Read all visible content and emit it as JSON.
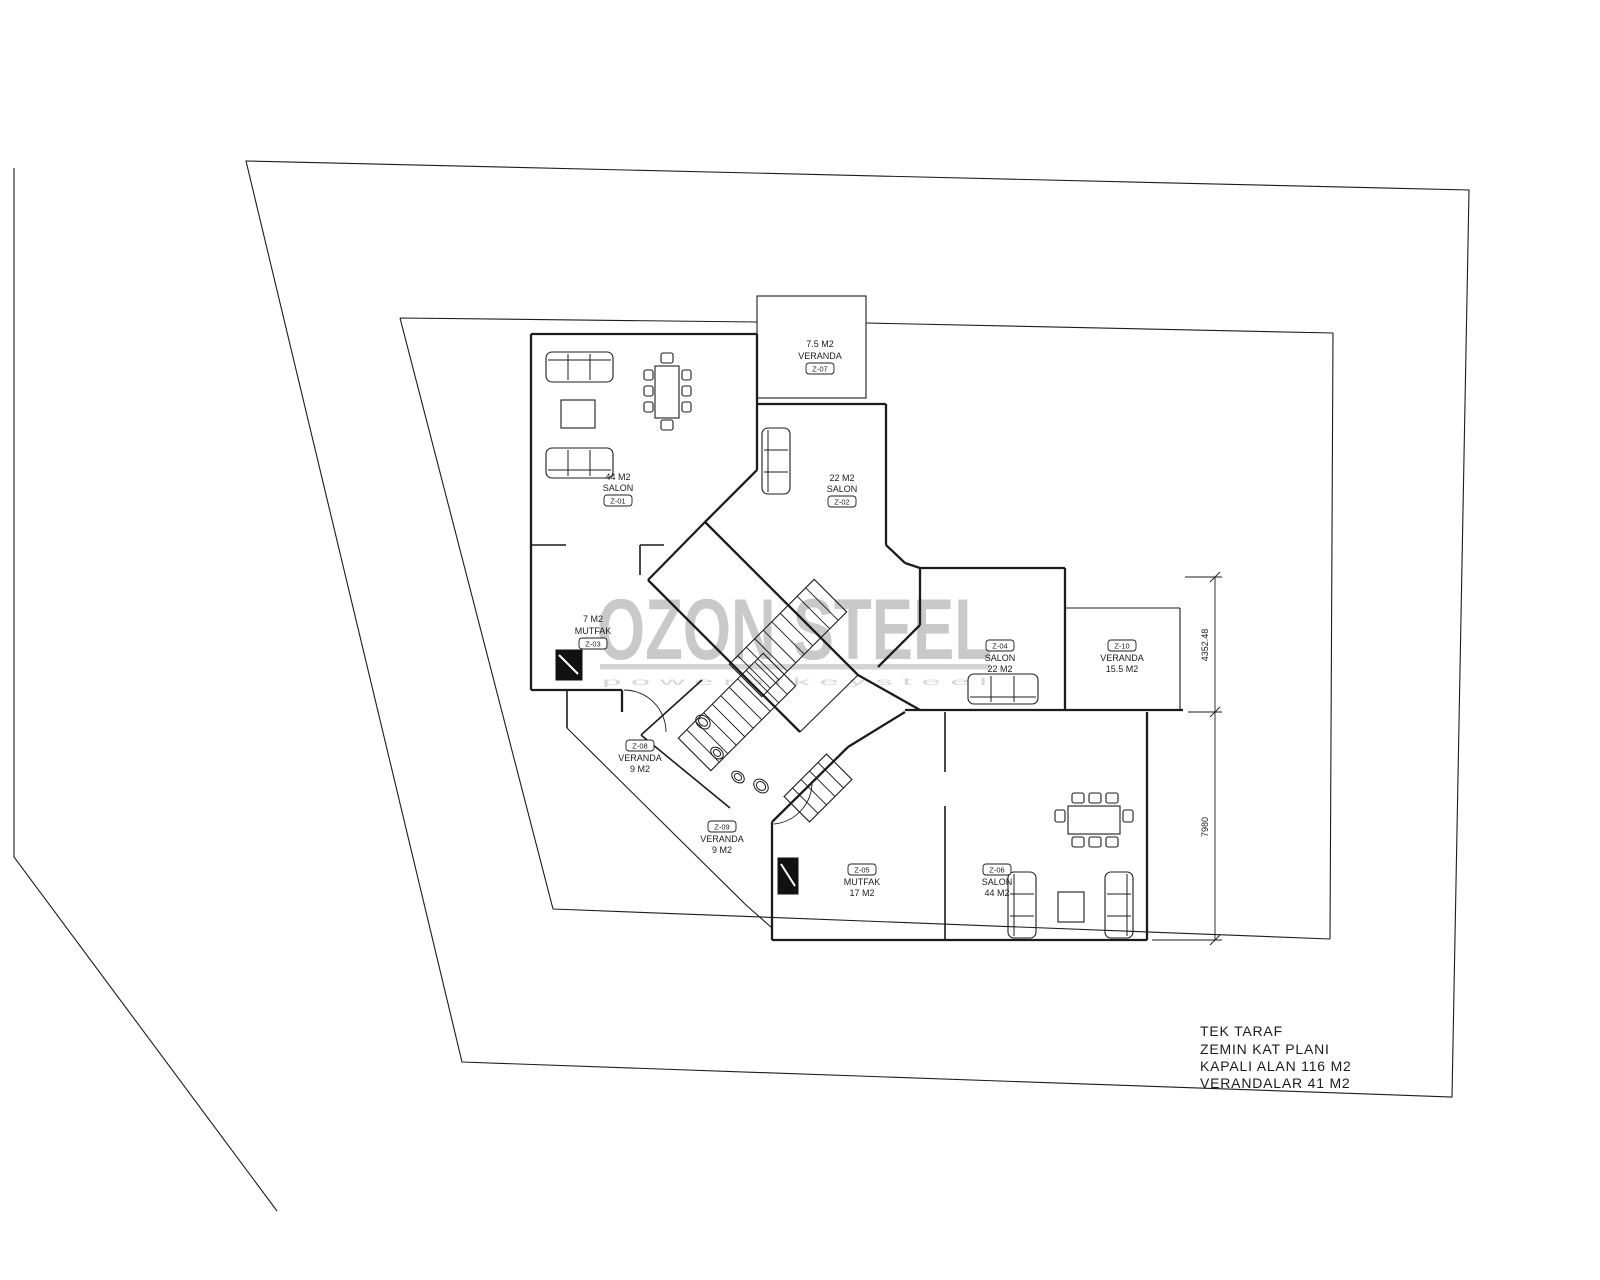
{
  "watermark": {
    "brand": "OZON STEEL",
    "tagline": "p o w e r   o f   k e y   s t e e l",
    "color": "#c9c9c9"
  },
  "title_block": {
    "lines": [
      "TEK TARAF",
      "ZEMIN KAT PLANI",
      "KAPALI ALAN 116 M2",
      "VERANDALAR 41 M2"
    ]
  },
  "rooms": [
    {
      "id": "salon-upper-left",
      "tag": "Z-01",
      "name": "SALON",
      "area": "44 M2"
    },
    {
      "id": "salon-upper-right",
      "tag": "Z-02",
      "name": "SALON",
      "area": "22 M2"
    },
    {
      "id": "veranda-top",
      "tag": "Z-07",
      "name": "VERANDA",
      "area": "7.5 M2"
    },
    {
      "id": "mutfak-upper",
      "tag": "Z-03",
      "name": "MUTFAK",
      "area": "7 M2"
    },
    {
      "id": "salon-right",
      "tag": "Z-04",
      "name": "SALON",
      "area": "22 M2"
    },
    {
      "id": "veranda-right",
      "tag": "Z-10",
      "name": "VERANDA",
      "area": "15.5 M2"
    },
    {
      "id": "veranda-middle",
      "tag": "Z-08",
      "name": "VERANDA",
      "area": "9 M2"
    },
    {
      "id": "veranda-lower",
      "tag": "Z-09",
      "name": "VERANDA",
      "area": "9 M2"
    },
    {
      "id": "mutfak-lower",
      "tag": "Z-05",
      "name": "MUTFAK",
      "area": "17 M2"
    },
    {
      "id": "salon-lower-right",
      "tag": "Z-06",
      "name": "SALON",
      "area": "44 M2"
    }
  ],
  "dimensions": {
    "upper": "4352.48",
    "lower": "7980"
  }
}
